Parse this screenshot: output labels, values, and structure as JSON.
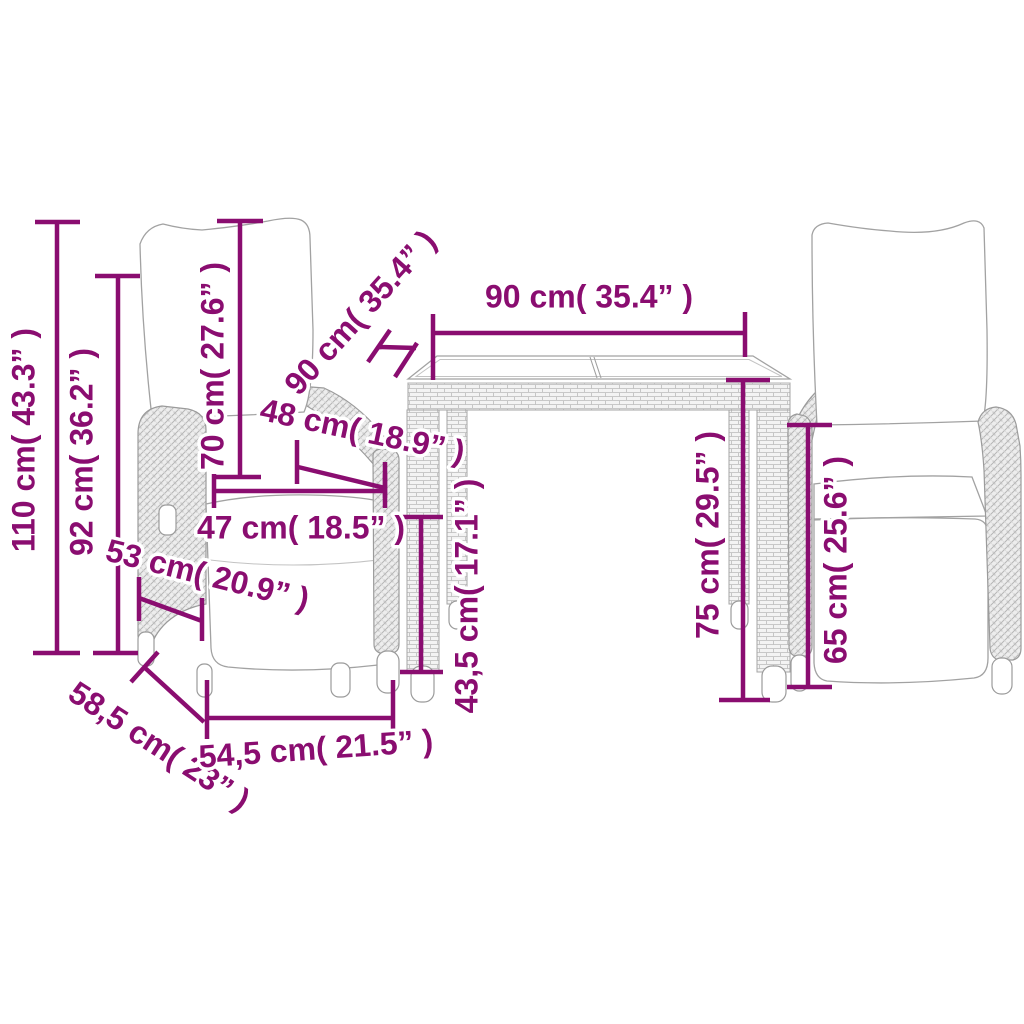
{
  "diagram": {
    "kind": "product-dimension-diagram",
    "subject": "garden-dining-set-two-reclining-chairs-and-table",
    "background": "#ffffff"
  },
  "colors": {
    "dimension_accent": "#8a0d70",
    "furniture_line": "#a2a2a2",
    "hatch_line": "#bdbdbd"
  },
  "dimensions": [
    {
      "id": "chair-total-height",
      "text": "110 cm( 43.3” )"
    },
    {
      "id": "chair-back-height",
      "text": "92 cm( 36.2” )"
    },
    {
      "id": "chair-backrest-height",
      "text": "70 cm( 27.6” )"
    },
    {
      "id": "table-depth",
      "text": "90 cm( 35.4” )"
    },
    {
      "id": "table-width",
      "text": "90 cm( 35.4” )"
    },
    {
      "id": "chair-seat-depth",
      "text": "48 cm( 18.9” )"
    },
    {
      "id": "chair-seat-width",
      "text": "47 cm( 18.5” )"
    },
    {
      "id": "chair-side-seat-depth",
      "text": "53 cm( 20.9” )"
    },
    {
      "id": "table-frame-clearance",
      "text": "43,5 cm( 17.1” )"
    },
    {
      "id": "table-height",
      "text": "75 cm( 29.5” )"
    },
    {
      "id": "chair-seatback-height",
      "text": "65 cm( 25.6” )"
    },
    {
      "id": "chair-base-depth",
      "text": "58,5 cm( 23” )"
    },
    {
      "id": "chair-base-width",
      "text": "54,5 cm( 21.5” )"
    }
  ]
}
